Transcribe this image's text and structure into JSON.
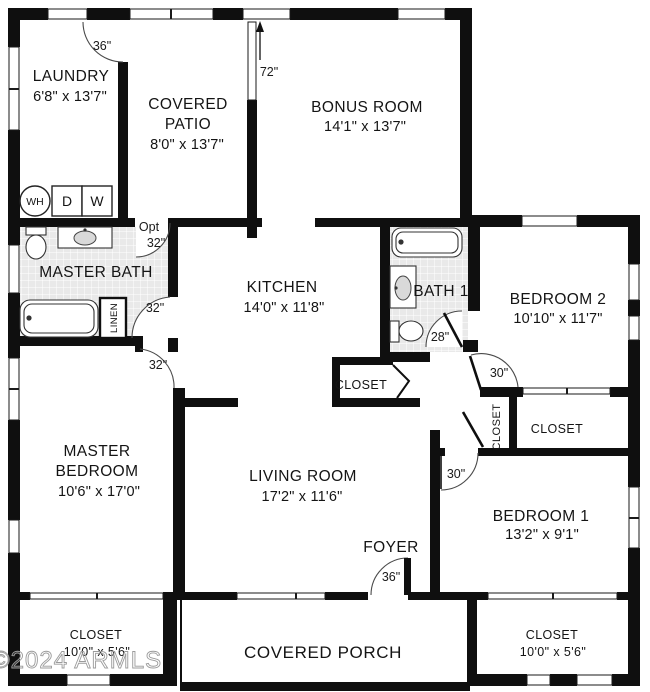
{
  "watermark": "©2024 ARMLS",
  "rooms": {
    "laundry": {
      "name": "LAUNDRY",
      "dims": "6'8\" x 13'7\""
    },
    "patio": {
      "line1": "COVERED",
      "line2": "PATIO",
      "dims": "8'0\" x 13'7\""
    },
    "bonus": {
      "name": "BONUS ROOM",
      "dims": "14'1\" x 13'7\""
    },
    "master_bath": {
      "name": "MASTER BATH"
    },
    "kitchen": {
      "name": "KITCHEN",
      "dims": "14'0\" x 11'8\""
    },
    "bath1": {
      "name": "BATH 1"
    },
    "bedroom2": {
      "name": "BEDROOM 2",
      "dims": "10'10\" x 11'7\""
    },
    "master_bedroom": {
      "line1": "MASTER",
      "line2": "BEDROOM",
      "dims": "10'6\" x 17'0\""
    },
    "living": {
      "name": "LIVING ROOM",
      "dims": "17'2\" x 11'6\""
    },
    "foyer": {
      "name": "FOYER"
    },
    "bedroom1": {
      "name": "BEDROOM 1",
      "dims": "13'2\" x 9'1\""
    },
    "closet_master": {
      "name": "CLOSET",
      "dims": "10'0\" x 5'6\""
    },
    "closet_bedroom1": {
      "name": "CLOSET",
      "dims": "10'0\" x 5'6\""
    },
    "closet_bedroom2": {
      "name": "CLOSET"
    },
    "closet_hall": {
      "name": "CLOSET"
    },
    "closet_kitchen": {
      "name": "CLOSET"
    },
    "linen": {
      "name": "LINEN"
    },
    "porch": {
      "name": "COVERED PORCH"
    }
  },
  "doors": {
    "laundry": "36\"",
    "patio_slider": "72\"",
    "opt_label": "Opt",
    "opt_size": "32\"",
    "master_bath": "32\"",
    "master_bedroom": "32\"",
    "bath1": "28\"",
    "bedroom2": "30\"",
    "bedroom1": "30\"",
    "foyer": "36\""
  },
  "fixtures": {
    "water_heater": "WH",
    "dryer": "D",
    "washer": "W"
  }
}
